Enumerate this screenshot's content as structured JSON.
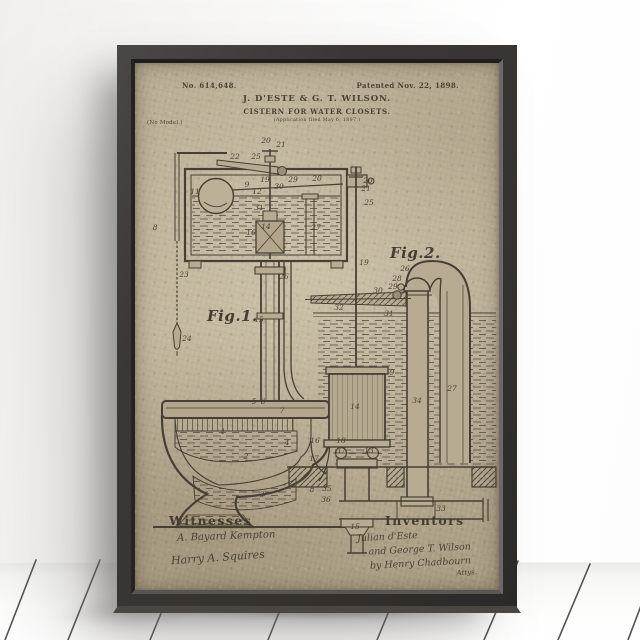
{
  "scene": {
    "wall_color": "#f5f4f2",
    "floor_color": "#f6f6f4",
    "plank_line_color": "#2e2d2b",
    "frame_color": "#3a3734",
    "poster_color": "#b7ac92",
    "ink_color": "#473f31"
  },
  "poster": {
    "patent_number": "No. 614,648.",
    "patent_date": "Patented Nov. 22, 1898.",
    "authors": "J. D'ESTE & G. T. WILSON.",
    "title": "CISTERN FOR WATER CLOSETS.",
    "application_note": "(Application filed May 6, 1897.)",
    "model_note": "(No Model.)",
    "fig1_label": "Fig.1.",
    "fig2_label": "Fig.2.",
    "witnesses": {
      "heading": "Witnesses",
      "signatures": [
        "A. Bayard Kempton",
        "Harry A. Squires"
      ]
    },
    "inventors": {
      "heading": "Inventors",
      "signatures": [
        "Julian d'Este",
        "and George T. Wilson",
        "by Henry Chadbourn",
        "Attys."
      ]
    },
    "callouts": [
      {
        "n": "20",
        "x": 131,
        "y": 80
      },
      {
        "n": "21",
        "x": 146,
        "y": 84
      },
      {
        "n": "25",
        "x": 121,
        "y": 96
      },
      {
        "n": "22",
        "x": 100,
        "y": 96
      },
      {
        "n": "19",
        "x": 130,
        "y": 119
      },
      {
        "n": "9",
        "x": 112,
        "y": 124
      },
      {
        "n": "12",
        "x": 122,
        "y": 131
      },
      {
        "n": "30",
        "x": 144,
        "y": 126
      },
      {
        "n": "29",
        "x": 158,
        "y": 119
      },
      {
        "n": "20",
        "x": 182,
        "y": 118
      },
      {
        "n": "11",
        "x": 60,
        "y": 131
      },
      {
        "n": "31",
        "x": 124,
        "y": 147
      },
      {
        "n": "14",
        "x": 131,
        "y": 166
      },
      {
        "n": "16",
        "x": 116,
        "y": 172
      },
      {
        "n": "27",
        "x": 181,
        "y": 167
      },
      {
        "n": "8",
        "x": 20,
        "y": 167
      },
      {
        "n": "26",
        "x": 149,
        "y": 216
      },
      {
        "n": "23",
        "x": 49,
        "y": 214
      },
      {
        "n": "24",
        "x": 52,
        "y": 278
      },
      {
        "n": "15",
        "x": 124,
        "y": 259
      },
      {
        "n": "5",
        "x": 119,
        "y": 341
      },
      {
        "n": "6",
        "x": 128,
        "y": 341
      },
      {
        "n": "7",
        "x": 147,
        "y": 350
      },
      {
        "n": "1",
        "x": 88,
        "y": 371
      },
      {
        "n": "2",
        "x": 111,
        "y": 396
      },
      {
        "n": "3",
        "x": 127,
        "y": 434
      },
      {
        "n": "4",
        "x": 152,
        "y": 382
      },
      {
        "n": "20",
        "x": 233,
        "y": 120
      },
      {
        "n": "21",
        "x": 231,
        "y": 128
      },
      {
        "n": "25",
        "x": 234,
        "y": 142
      },
      {
        "n": "19",
        "x": 229,
        "y": 202
      },
      {
        "n": "26",
        "x": 270,
        "y": 208
      },
      {
        "n": "28",
        "x": 262,
        "y": 218
      },
      {
        "n": "29",
        "x": 258,
        "y": 226
      },
      {
        "n": "30",
        "x": 243,
        "y": 230
      },
      {
        "n": "32",
        "x": 204,
        "y": 247
      },
      {
        "n": "31",
        "x": 254,
        "y": 253
      },
      {
        "n": "9",
        "x": 257,
        "y": 312
      },
      {
        "n": "14",
        "x": 220,
        "y": 346
      },
      {
        "n": "27",
        "x": 317,
        "y": 328
      },
      {
        "n": "34",
        "x": 282,
        "y": 340
      },
      {
        "n": "16",
        "x": 180,
        "y": 380
      },
      {
        "n": "18",
        "x": 206,
        "y": 380
      },
      {
        "n": "37",
        "x": 206,
        "y": 390
      },
      {
        "n": "13",
        "x": 234,
        "y": 390
      },
      {
        "n": "17",
        "x": 179,
        "y": 398
      },
      {
        "n": "8",
        "x": 177,
        "y": 429
      },
      {
        "n": "35",
        "x": 192,
        "y": 428
      },
      {
        "n": "36",
        "x": 191,
        "y": 439
      },
      {
        "n": "15",
        "x": 220,
        "y": 466
      },
      {
        "n": "33",
        "x": 306,
        "y": 448
      }
    ]
  }
}
